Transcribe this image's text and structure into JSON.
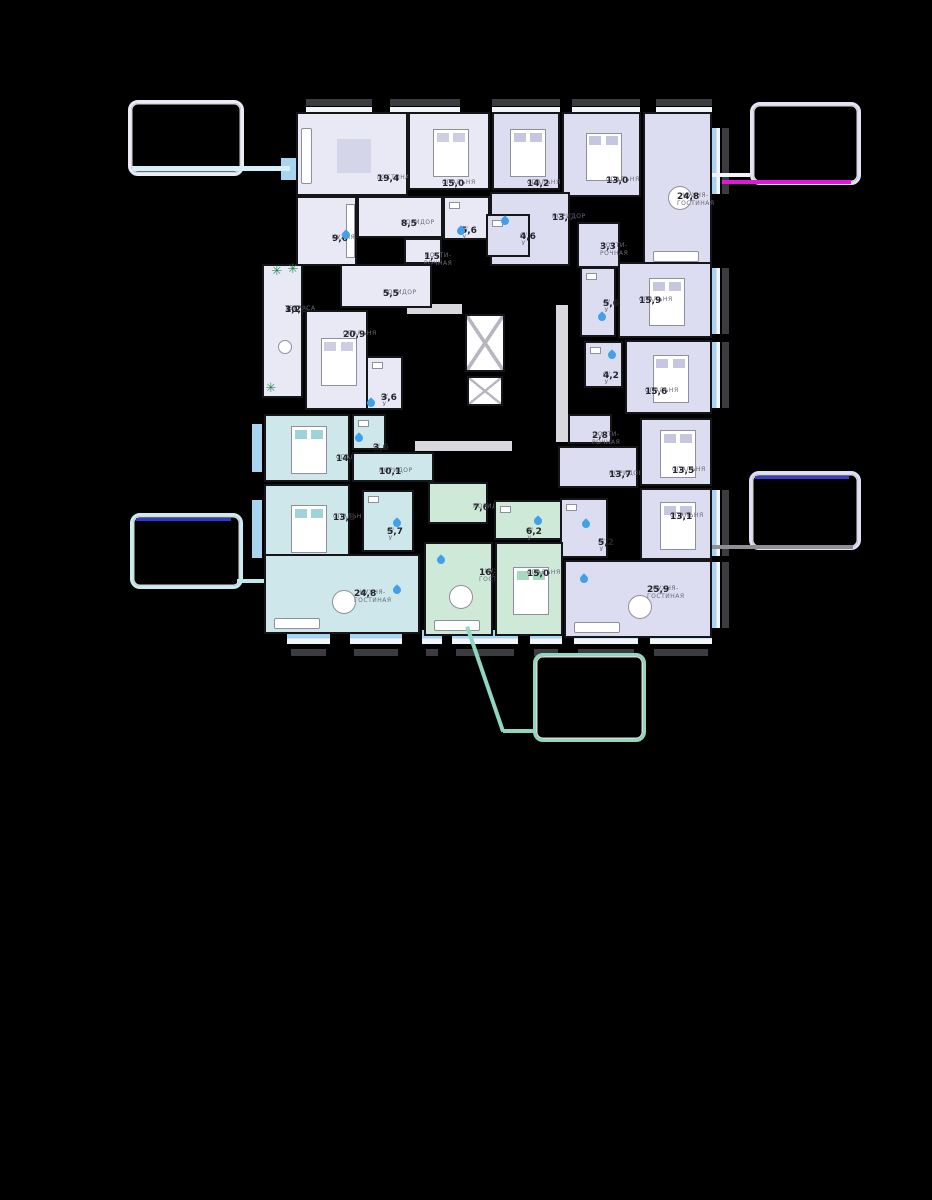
{
  "canvas": {
    "width": 932,
    "height": 1200,
    "background": "#000000"
  },
  "icons": {
    "plant": "✳",
    "water_drop": "drop-shape",
    "elevator": "crossed-box"
  },
  "palette": {
    "walls": "#15151a",
    "window_blue": "#a8d4ef",
    "facade_bar": "#3b3b40",
    "drop_blue": "#41a0e8",
    "plant_green": "#2f8a55",
    "accent_magenta": "#e316df",
    "accent_blue": "#3a3ccc",
    "accent_cyan": "#d6effa",
    "accent_teal": "#8ed7c3",
    "accent_gray": "#8f8f96"
  },
  "units": [
    {
      "id": "a",
      "color": "#e9e9f6",
      "tint": "#cdcde4",
      "rooms": [
        {
          "label": "ГОСТИНАЯ",
          "area": "19,4",
          "type": "living",
          "x": 296,
          "y": 112,
          "w": 112,
          "h": 84,
          "lx": 375,
          "ly": 172
        },
        {
          "label": "СПАЛЬНЯ",
          "area": "15,0",
          "type": "bedroom",
          "x": 408,
          "y": 112,
          "w": 82,
          "h": 78,
          "lx": 440,
          "ly": 177
        },
        {
          "label": "КУХНЯ",
          "area": "9,6",
          "type": "kitchen",
          "x": 296,
          "y": 196,
          "w": 61,
          "h": 70,
          "lx": 330,
          "ly": 232
        },
        {
          "label": "КОРИДОР",
          "area": "8,5",
          "type": "corridor",
          "x": 357,
          "y": 196,
          "w": 86,
          "h": 42,
          "lx": 399,
          "ly": 217
        },
        {
          "label": "С/У",
          "area": "5,6",
          "type": "bathroom",
          "x": 443,
          "y": 196,
          "w": 47,
          "h": 44,
          "lx": 459,
          "ly": 224
        },
        {
          "label": "ПОСТИ-\nРОЧНАЯ",
          "area": "1,5",
          "type": "laundry",
          "x": 404,
          "y": 238,
          "w": 38,
          "h": 26,
          "lx": 422,
          "ly": 250
        },
        {
          "label": "КОРИДОР",
          "area": "5,5",
          "type": "corridor",
          "x": 340,
          "y": 264,
          "w": 92,
          "h": 44,
          "lx": 381,
          "ly": 287
        },
        {
          "label": "ТЕРРАСА",
          "area": "3,2",
          "area2": "10,6",
          "type": "terrace",
          "x": 262,
          "y": 264,
          "w": 41,
          "h": 134,
          "lx": 283,
          "ly": 303
        },
        {
          "label": "СПАЛЬНЯ",
          "area": "20,9",
          "type": "bedroom",
          "x": 305,
          "y": 310,
          "w": 63,
          "h": 100,
          "lx": 341,
          "ly": 328
        },
        {
          "label": "С/У",
          "area": "3,6",
          "type": "bathroom",
          "x": 366,
          "y": 356,
          "w": 37,
          "h": 54,
          "lx": 379,
          "ly": 391
        }
      ]
    },
    {
      "id": "b",
      "color": "#dcddf0",
      "tint": "#c6c6e0",
      "rooms": [
        {
          "label": "СПАЛЬНЯ",
          "area": "14,2",
          "type": "bedroom",
          "x": 492,
          "y": 112,
          "w": 68,
          "h": 78,
          "lx": 525,
          "ly": 177
        },
        {
          "label": "СПАЛЬНЯ",
          "area": "13,0",
          "type": "bedroom",
          "x": 562,
          "y": 112,
          "w": 79,
          "h": 85,
          "lx": 604,
          "ly": 174
        },
        {
          "label": "КУХНЯ-\nГОСТИНАЯ",
          "area": "24,8",
          "type": "kitchen_living",
          "x": 643,
          "y": 112,
          "w": 69,
          "h": 155,
          "lx": 675,
          "ly": 190
        },
        {
          "label": "КОРИДОР",
          "area": "13,0",
          "type": "corridor",
          "x": 490,
          "y": 192,
          "w": 80,
          "h": 74,
          "lx": 550,
          "ly": 211
        },
        {
          "label": "С/У",
          "area": "4,6",
          "type": "bathroom",
          "x": 486,
          "y": 214,
          "w": 44,
          "h": 43,
          "lx": 518,
          "ly": 230
        },
        {
          "label": "ПОСТИ-\nРОЧНАЯ",
          "area": "3,3",
          "type": "laundry",
          "x": 577,
          "y": 222,
          "w": 43,
          "h": 46,
          "lx": 598,
          "ly": 240
        }
      ]
    },
    {
      "id": "c",
      "color": "#dcddf0",
      "tint": "#c6c6e0",
      "rooms": [
        {
          "label": "С/У",
          "area": "5,6",
          "type": "bathroom",
          "x": 580,
          "y": 267,
          "w": 36,
          "h": 70,
          "lx": 601,
          "ly": 297
        },
        {
          "label": "СПАЛЬНЯ",
          "area": "15,9",
          "type": "bedroom",
          "x": 618,
          "y": 262,
          "w": 94,
          "h": 76,
          "lx": 637,
          "ly": 294
        },
        {
          "label": "С/У",
          "area": "4,2",
          "type": "bathroom",
          "x": 584,
          "y": 341,
          "w": 39,
          "h": 47,
          "lx": 601,
          "ly": 369
        },
        {
          "label": "СПАЛЬНЯ",
          "area": "15,6",
          "type": "bedroom",
          "x": 625,
          "y": 340,
          "w": 87,
          "h": 74,
          "lx": 643,
          "ly": 385
        },
        {
          "label": "ПОСТИ-\nРОЧНАЯ",
          "area": "2,8",
          "type": "laundry",
          "x": 568,
          "y": 414,
          "w": 44,
          "h": 30,
          "lx": 590,
          "ly": 429
        },
        {
          "label": "КОРИДОР",
          "area": "13,7",
          "type": "corridor",
          "x": 558,
          "y": 446,
          "w": 80,
          "h": 42,
          "lx": 607,
          "ly": 468
        },
        {
          "label": "СПАЛЬНЯ",
          "area": "13,5",
          "type": "bedroom",
          "x": 640,
          "y": 418,
          "w": 72,
          "h": 68,
          "lx": 670,
          "ly": 464
        },
        {
          "label": "СПАЛЬНЯ",
          "area": "13,1",
          "type": "bedroom",
          "x": 640,
          "y": 488,
          "w": 72,
          "h": 72,
          "lx": 668,
          "ly": 510
        },
        {
          "label": "С/У",
          "area": "5,2",
          "type": "bathroom",
          "x": 560,
          "y": 498,
          "w": 48,
          "h": 60,
          "lx": 596,
          "ly": 536
        },
        {
          "label": "КУХНЯ-\nГОСТИНАЯ",
          "area": "25,9",
          "type": "kitchen_living",
          "x": 564,
          "y": 560,
          "w": 148,
          "h": 78,
          "lx": 645,
          "ly": 583
        }
      ]
    },
    {
      "id": "d",
      "color": "#cde7eb",
      "tint": "#9fd2da",
      "rooms": [
        {
          "label": "СПАЛЬНЯ",
          "area": "14,1",
          "type": "bedroom",
          "x": 264,
          "y": 414,
          "w": 86,
          "h": 68,
          "lx": 334,
          "ly": 452
        },
        {
          "label": "С/У",
          "area": "3,6",
          "type": "bathroom",
          "x": 352,
          "y": 414,
          "w": 34,
          "h": 36,
          "lx": 371,
          "ly": 441
        },
        {
          "label": "КОРИДОР",
          "area": "10,1",
          "type": "corridor",
          "x": 352,
          "y": 452,
          "w": 82,
          "h": 30,
          "lx": 377,
          "ly": 465
        },
        {
          "label": "СПАЛЬНЯ",
          "area": "13,3",
          "type": "bedroom",
          "x": 264,
          "y": 484,
          "w": 86,
          "h": 86,
          "lx": 331,
          "ly": 511
        },
        {
          "label": "С/У",
          "area": "5,7",
          "type": "bathroom",
          "x": 362,
          "y": 490,
          "w": 52,
          "h": 62,
          "lx": 385,
          "ly": 525
        },
        {
          "label": "КУХНЯ-\nГОСТИНАЯ",
          "area": "24,8",
          "type": "kitchen_living",
          "x": 264,
          "y": 554,
          "w": 156,
          "h": 80,
          "lx": 352,
          "ly": 587
        }
      ]
    },
    {
      "id": "e",
      "color": "#cfe9d9",
      "tint": "#a5d8bf",
      "rooms": [
        {
          "label": "КОРИДОР",
          "area": "7,6",
          "type": "corridor",
          "x": 428,
          "y": 482,
          "w": 60,
          "h": 42,
          "lx": 471,
          "ly": 501
        },
        {
          "label": "С/У",
          "area": "6,2",
          "type": "bathroom",
          "x": 494,
          "y": 500,
          "w": 68,
          "h": 40,
          "lx": 524,
          "ly": 525
        },
        {
          "label": "КУХНЯ-\nГОСТИНАЯ",
          "area": "16,2",
          "type": "kitchen_living",
          "x": 424,
          "y": 542,
          "w": 69,
          "h": 94,
          "lx": 477,
          "ly": 566
        },
        {
          "label": "СПАЛЬНЯ",
          "area": "15,0",
          "type": "bedroom",
          "x": 495,
          "y": 542,
          "w": 68,
          "h": 94,
          "lx": 525,
          "ly": 567
        }
      ]
    }
  ],
  "core": {
    "strips": [
      [
        407,
        304,
        55,
        10
      ],
      [
        556,
        305,
        12,
        137
      ],
      [
        415,
        441,
        97,
        10
      ]
    ],
    "elevators": [
      [
        465,
        314,
        40,
        58
      ],
      [
        467,
        376,
        36,
        30
      ]
    ]
  },
  "balconies": {
    "top": [
      [
        306,
        66
      ],
      [
        390,
        70
      ],
      [
        492,
        68
      ],
      [
        572,
        68
      ],
      [
        656,
        56
      ]
    ],
    "bottom": [
      [
        287,
        43
      ],
      [
        350,
        52
      ],
      [
        422,
        20
      ],
      [
        452,
        66
      ],
      [
        530,
        32
      ],
      [
        574,
        64
      ],
      [
        650,
        62
      ]
    ],
    "right": [
      [
        128,
        66
      ],
      [
        268,
        66
      ],
      [
        342,
        66
      ],
      [
        490,
        66
      ],
      [
        562,
        66
      ]
    ],
    "left": [
      [
        281,
        158,
        15,
        22
      ],
      [
        252,
        424,
        10,
        48
      ],
      [
        252,
        500,
        10,
        58
      ]
    ]
  },
  "drops": [
    [
      461,
      231
    ],
    [
      346,
      235
    ],
    [
      505,
      221
    ],
    [
      602,
      317
    ],
    [
      612,
      355
    ],
    [
      371,
      403
    ],
    [
      359,
      438
    ],
    [
      397,
      523
    ],
    [
      397,
      590
    ],
    [
      441,
      560
    ],
    [
      538,
      521
    ],
    [
      586,
      524
    ],
    [
      584,
      579
    ]
  ],
  "plants": [
    [
      277,
      272
    ],
    [
      293,
      270
    ],
    [
      271,
      389
    ]
  ],
  "callouts": [
    {
      "id": "top-left",
      "x": 128,
      "y": 100,
      "w": 110,
      "h": 70,
      "border": "#ececf8",
      "lines": [
        {
          "x": 132,
          "y": 166,
          "w": 158,
          "h": 5,
          "color": "#d6effa"
        }
      ]
    },
    {
      "id": "top-right",
      "x": 750,
      "y": 102,
      "w": 105,
      "h": 77,
      "border": "#e4e4f6",
      "lines": [
        {
          "x": 712,
          "y": 173,
          "w": 38,
          "h": 4,
          "color": "#f2f2fa"
        },
        {
          "x": 722,
          "y": 180,
          "w": 129,
          "h": 4,
          "color": "#e316df"
        }
      ]
    },
    {
      "id": "mid-left",
      "x": 130,
      "y": 513,
      "w": 107,
      "h": 70,
      "border": "#c9ecf2",
      "lines": [
        {
          "x": 136,
          "y": 518,
          "w": 95,
          "h": 3,
          "color": "#3338cc"
        },
        {
          "x": 237,
          "y": 579,
          "w": 27,
          "h": 4,
          "color": "#bfe9ef"
        }
      ]
    },
    {
      "id": "mid-right",
      "x": 749,
      "y": 471,
      "w": 106,
      "h": 73,
      "border": "#dedef6",
      "lines": [
        {
          "x": 755,
          "y": 476,
          "w": 94,
          "h": 3,
          "color": "#3a3ccc"
        },
        {
          "x": 712,
          "y": 545,
          "w": 141,
          "h": 4,
          "color": "#8f8f96"
        }
      ]
    },
    {
      "id": "bottom",
      "x": 533,
      "y": 653,
      "w": 107,
      "h": 83,
      "border": "#8ed7c3",
      "diag": {
        "x1": 469,
        "y1": 626,
        "x2": 505,
        "y2": 731
      },
      "lines": [
        {
          "x": 503,
          "y": 729,
          "w": 32,
          "h": 4,
          "color": "#8ed7c3"
        }
      ]
    }
  ]
}
